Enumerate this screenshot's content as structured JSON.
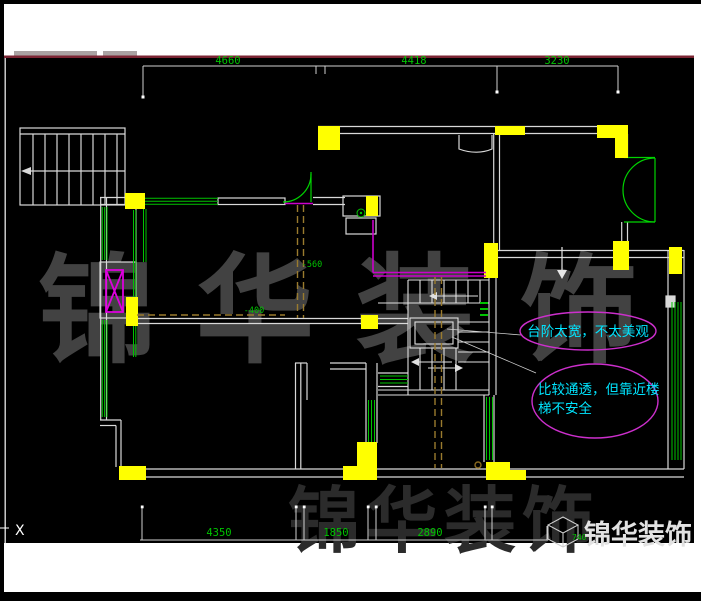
{
  "title": "floor-plan-cad-drawing",
  "colors": {
    "canvas": "#000000",
    "wall": "#d9d9d9",
    "column_yellow": "#ffff00",
    "window_green": "#00c400",
    "door_green": "#00d400",
    "dimension_green": "#00c400",
    "note_cyan": "#00e5ff",
    "ellipse_magenta": "#cc2fcc",
    "beam_brown": "#9a7b2e",
    "top_rule_maroon": "#7b2433",
    "watermark_gray": "#424242"
  },
  "dimensions_top": [
    {
      "value": "4660"
    },
    {
      "value": "4418"
    },
    {
      "value": "3230"
    }
  ],
  "dimensions_bottom": [
    {
      "value": "4350"
    },
    {
      "value": "1850"
    },
    {
      "value": "2890"
    }
  ],
  "level_marks": [
    {
      "value": "-560"
    },
    {
      "value": "-400"
    }
  ],
  "axis_label": "X",
  "notes": {
    "note1": "台阶太宽，不太美观",
    "note2_line1": "比较通透，但靠近楼",
    "note2_line2": "梯不安全"
  },
  "watermark": {
    "char1": "锦",
    "char2": "华",
    "char3": "装",
    "char4": "饰",
    "row2": "锦华装饰"
  },
  "logo": {
    "brand": "锦华装饰",
    "dim_label": "740"
  }
}
